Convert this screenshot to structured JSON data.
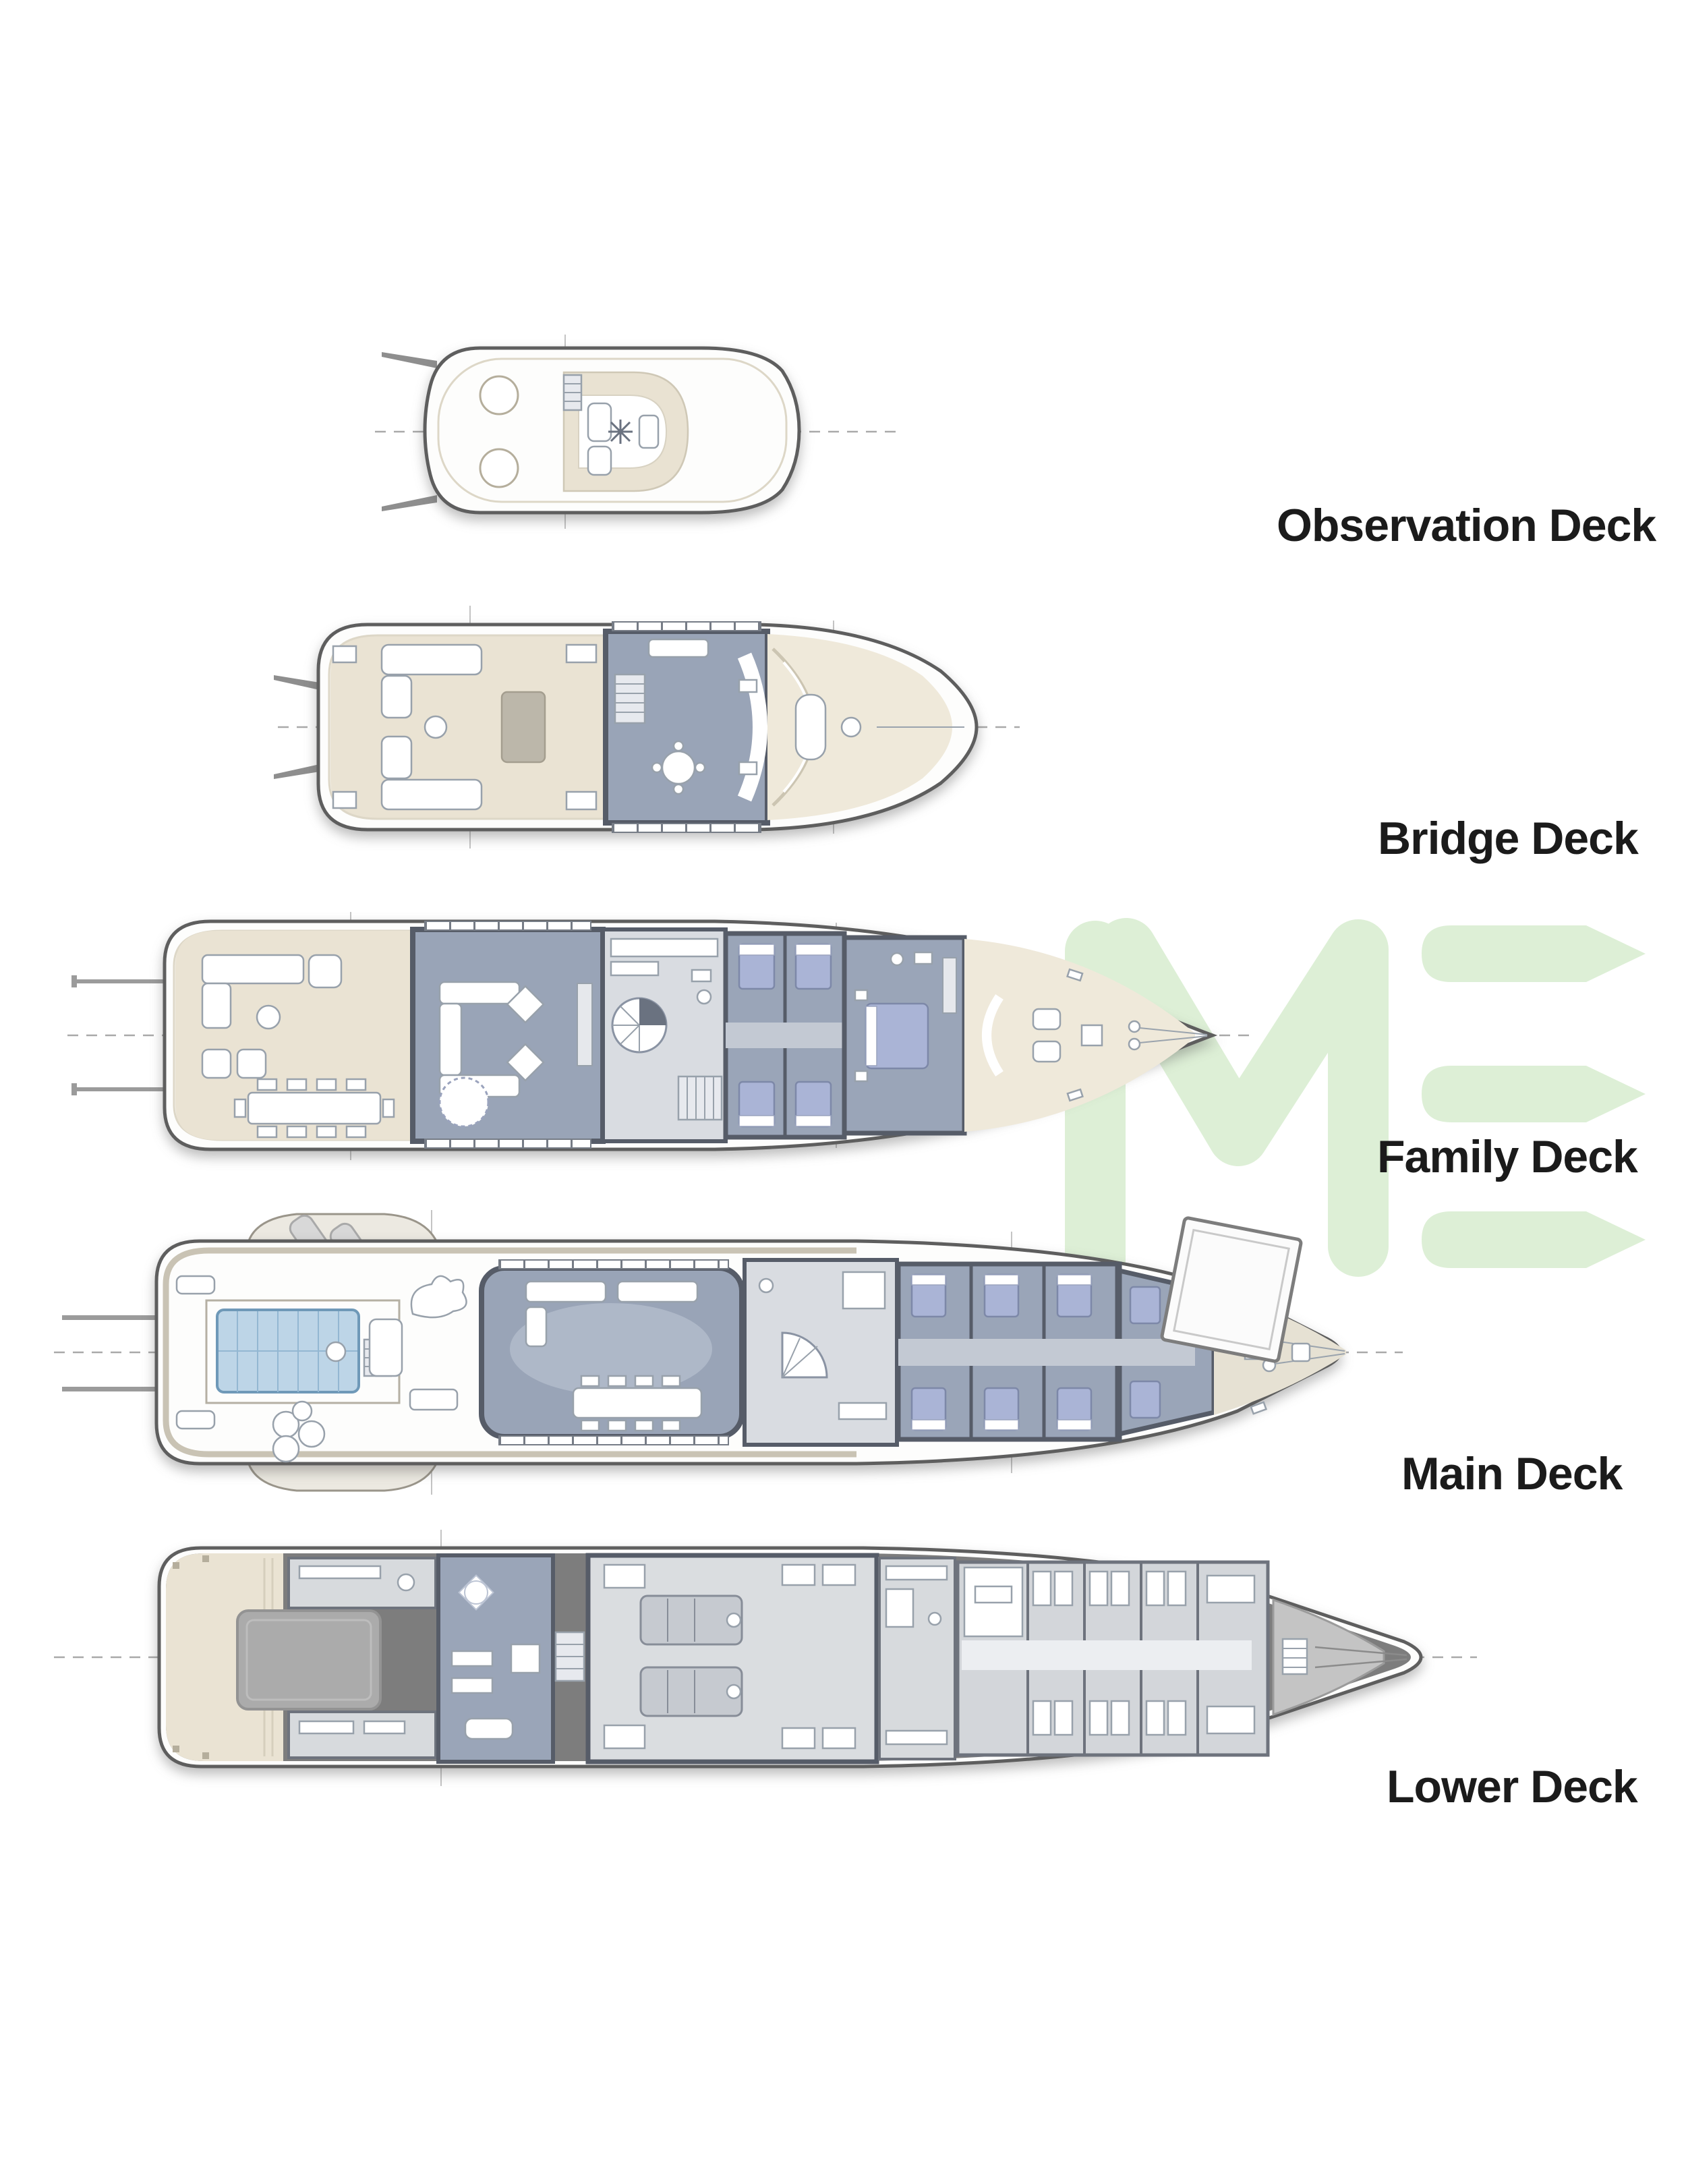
{
  "decks": [
    {
      "id": "observation",
      "label": "Observation Deck"
    },
    {
      "id": "bridge",
      "label": "Bridge Deck"
    },
    {
      "id": "family",
      "label": "Family Deck"
    },
    {
      "id": "main",
      "label": "Main Deck"
    },
    {
      "id": "lower",
      "label": "Lower Deck"
    }
  ],
  "watermark": {
    "letters": "IME",
    "color": "#ddefd6"
  },
  "palette": {
    "hull_outline": "#5e5e5e",
    "deck_beige": "#eae3d3",
    "room_blue_gray": "#99a4b7",
    "wall_slate": "#565c68",
    "room_light": "#d9dce1",
    "bed_blue": "#aab4d6",
    "pool_blue": "#bdd5e7",
    "lower_deck_gray": "#7d7d7d",
    "label_color": "#1b1b1b"
  }
}
